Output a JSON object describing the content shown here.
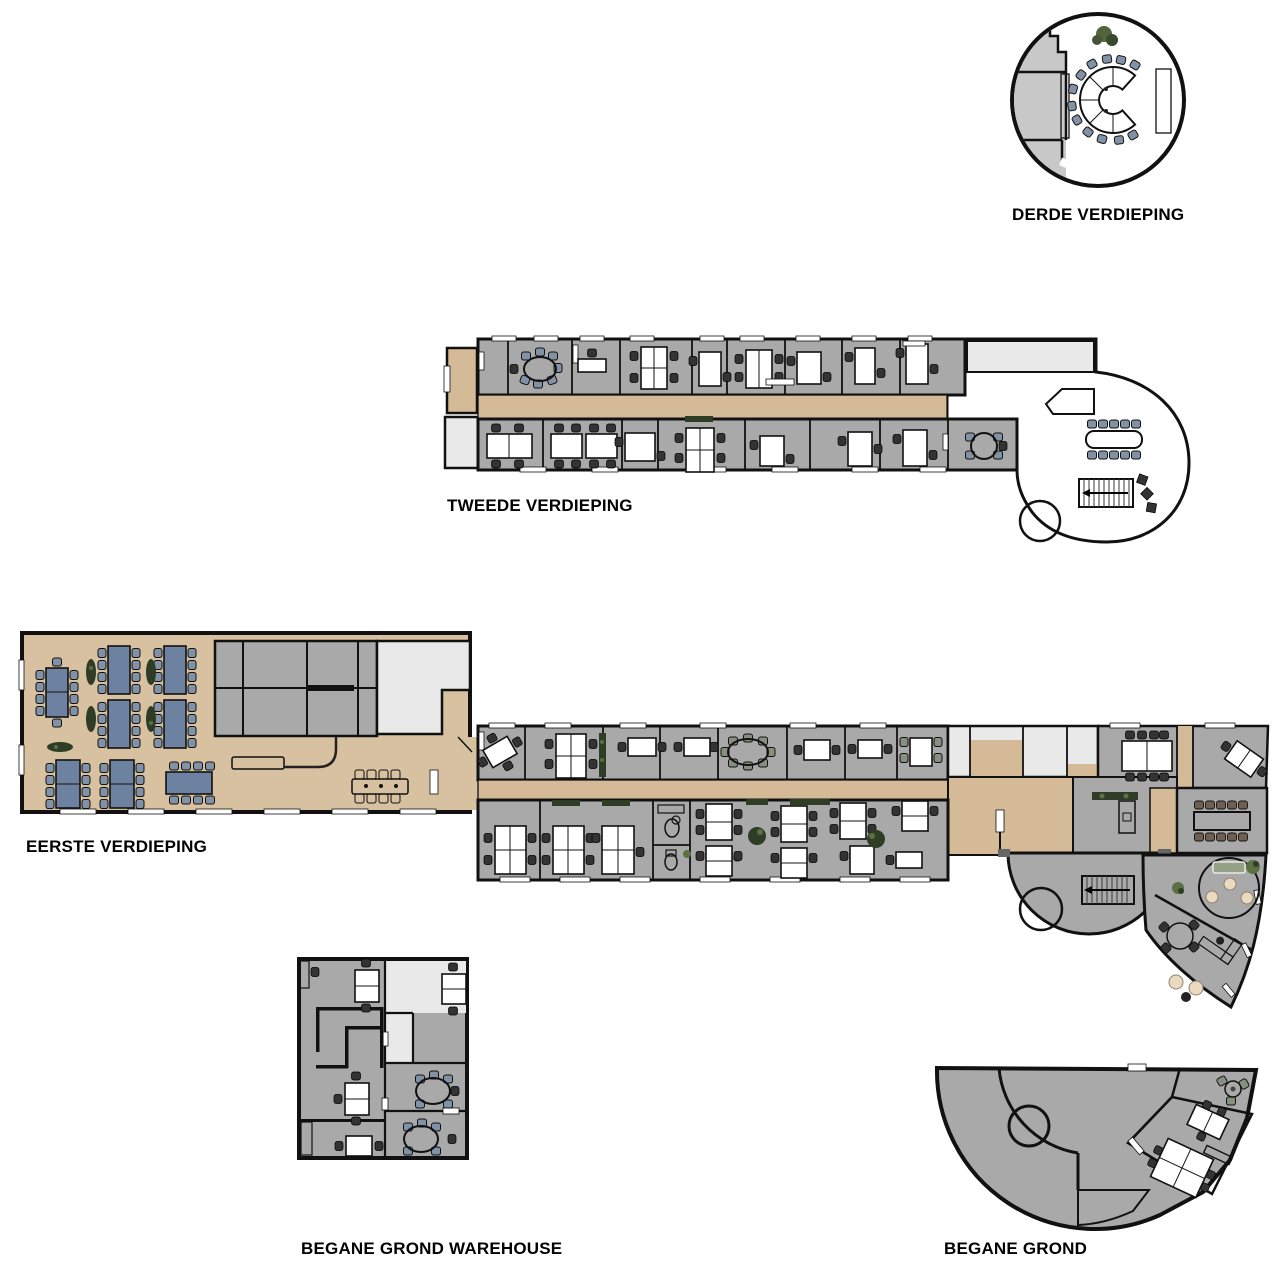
{
  "page": {
    "background": "#ffffff"
  },
  "floors": [
    {
      "id": "derde",
      "label": "DERDE VERDIEPING",
      "description": "circular top floor with horseshoe conference table"
    },
    {
      "id": "tweede",
      "label": "TWEEDE VERDIEPING",
      "description": "long office floor with central corridor and round lounge"
    },
    {
      "id": "eerste",
      "label": "EERSTE VERDIEPING",
      "description": "canteen with blue tables, office wing, stair rotunda and lounge wedge"
    },
    {
      "id": "warehouse",
      "label": "BEGANE GROND WAREHOUSE",
      "description": "warehouse ground floor offices"
    },
    {
      "id": "begane",
      "label": "BEGANE GROND",
      "description": "fan shaped ground floor"
    }
  ],
  "palette": {
    "background": "#ffffff",
    "wall": "#111111",
    "wood_floor": "#d8c1a1",
    "corridor_floor": "#d5ba97",
    "carpet_gray": "#a9a9a9",
    "carpet_light": "#e9e9e9",
    "carpet_blue": "#76818f",
    "carpet_green": "#73815f",
    "table_blue": "#6d81a0",
    "chair_blue": "#8292a6",
    "chair_dark": "#333333",
    "desk_white": "#ffffff",
    "wood_table": "#d3a87c",
    "stair_wood": "#c3a179",
    "plant_dark": "#2f3d26",
    "plant_green": "#5c7045",
    "cream": "#eadbc0",
    "door_brown": "#6e6053",
    "dark_room": "#575757",
    "counter": "#b3a998",
    "stool_teal": "#4e5f66"
  }
}
